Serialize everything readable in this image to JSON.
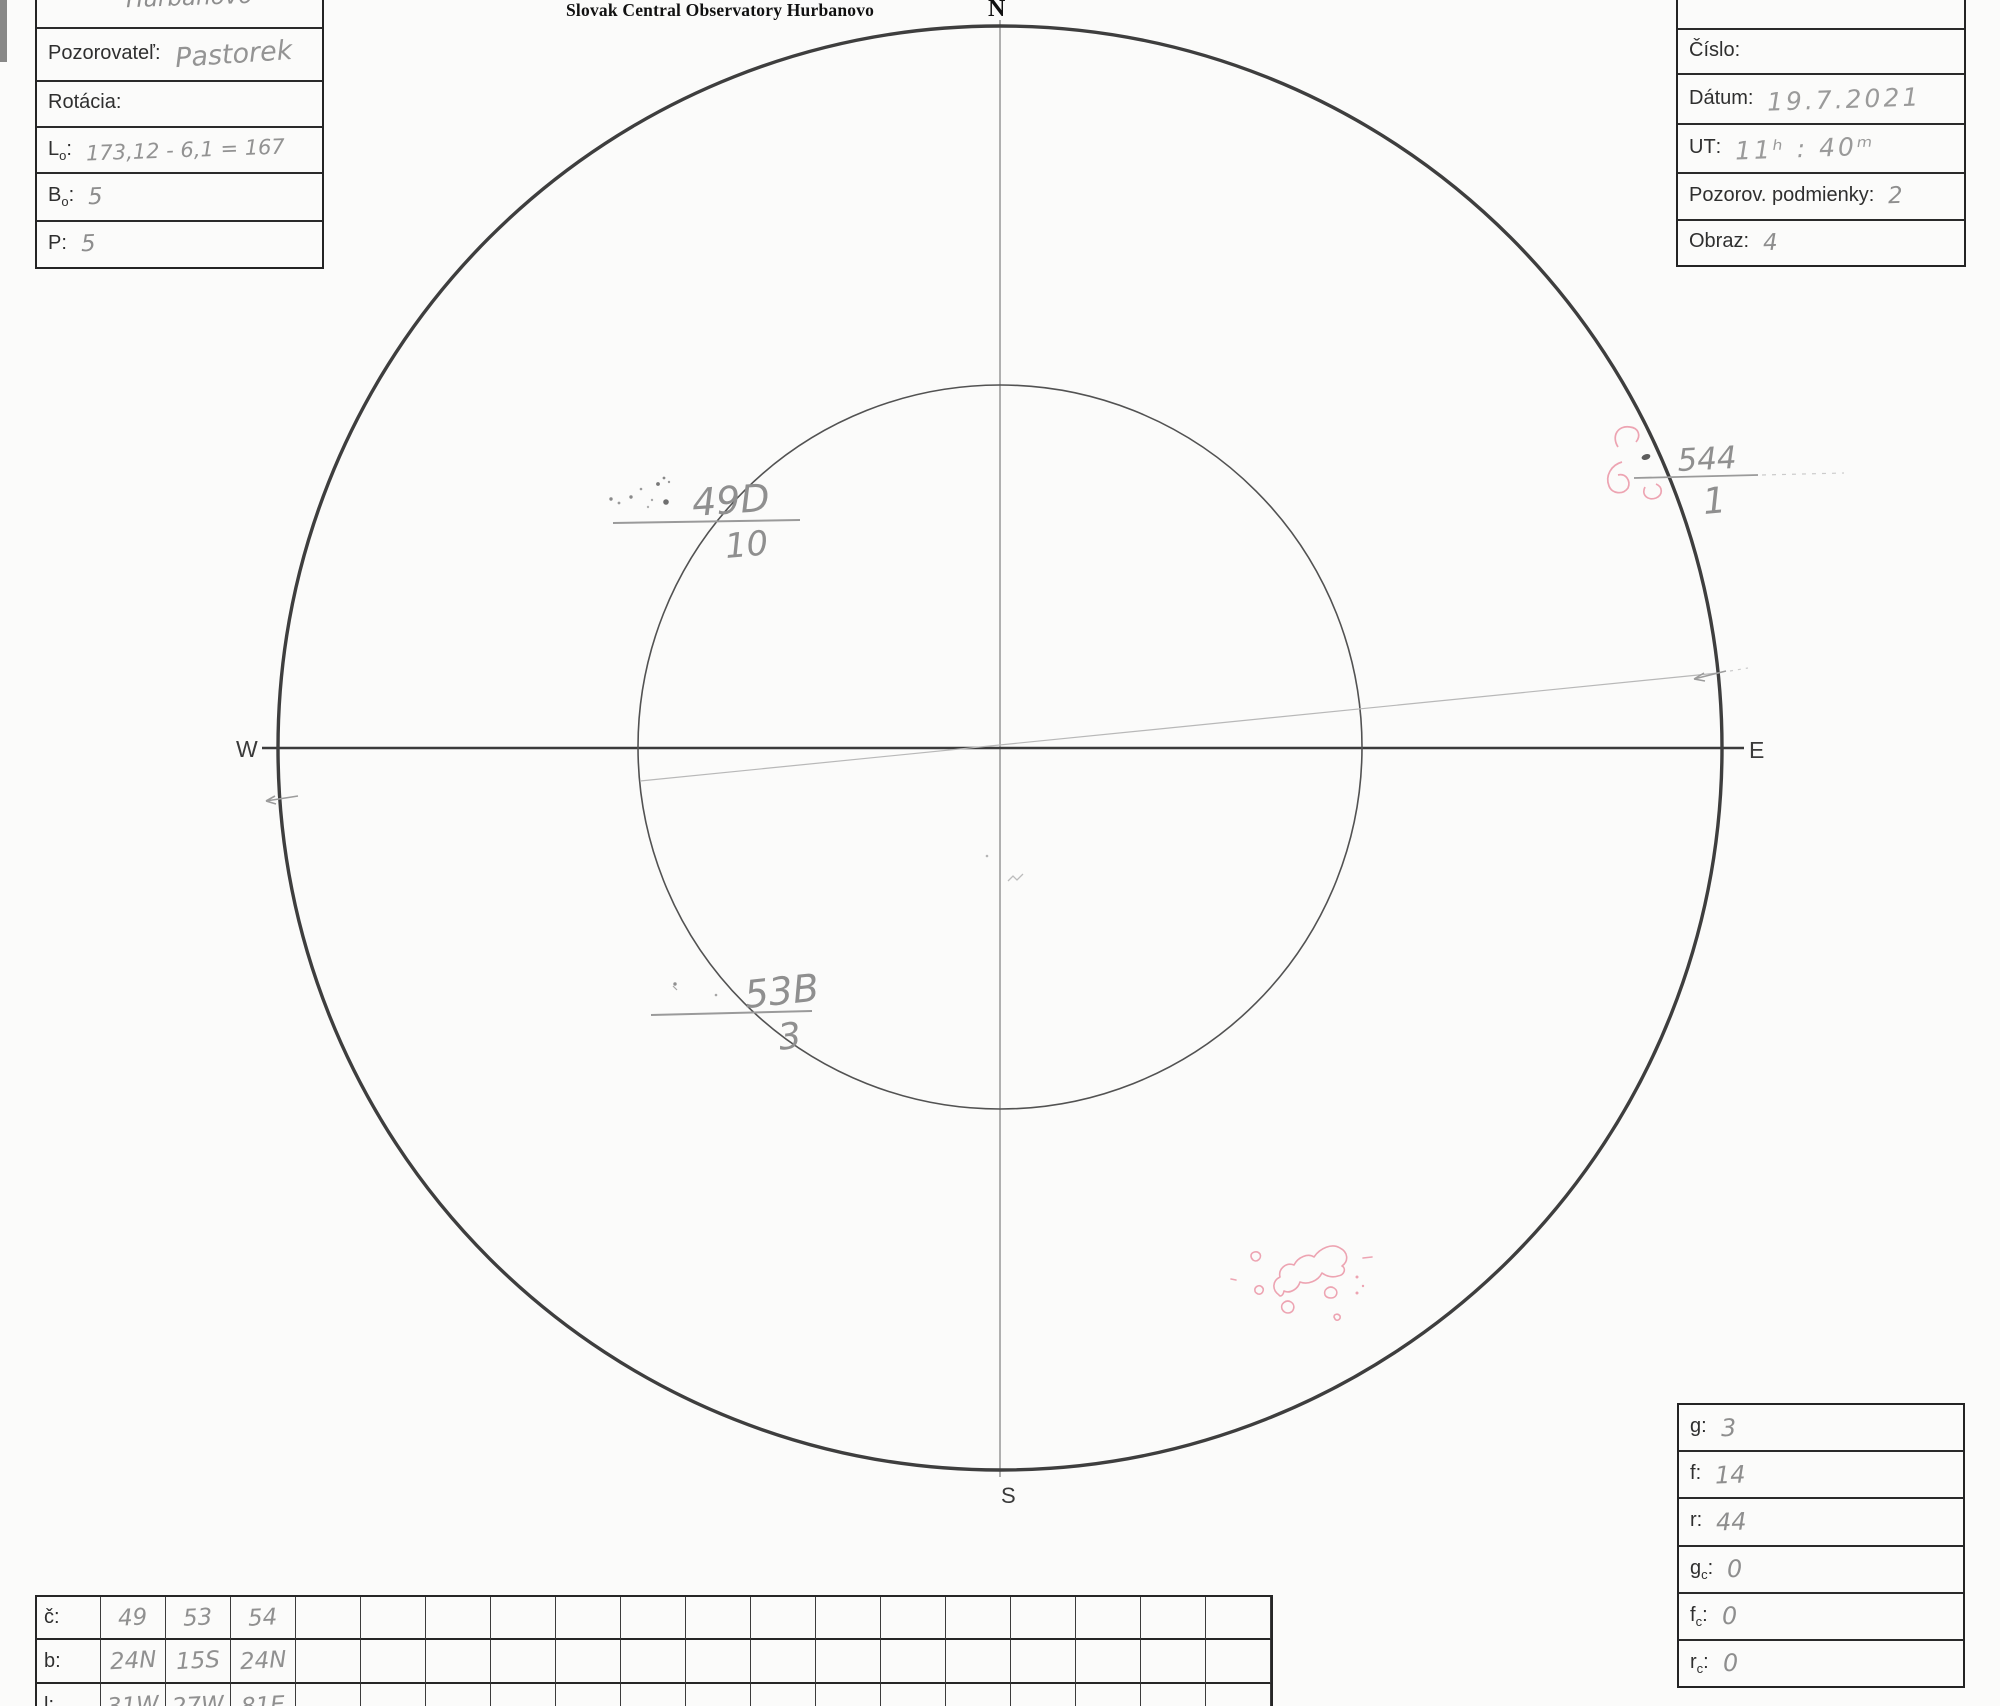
{
  "title": "Slovak Central Observatory Hurbanovo",
  "left_form": {
    "fields": [
      {
        "main": "Miesto",
        "sub": "",
        "post": ":",
        "value": "Hurbanovo"
      },
      {
        "main": "Pozorovateľ",
        "sub": "",
        "post": ":",
        "value": "Pastorek"
      },
      {
        "main": "Rotácia",
        "sub": "",
        "post": ":",
        "value": ""
      },
      {
        "main": "L",
        "sub": "o",
        "post": ":",
        "value": "173,12 - 6,1 = 167"
      },
      {
        "main": "B",
        "sub": "o",
        "post": ":",
        "value": "5"
      },
      {
        "main": "P",
        "sub": "",
        "post": ":",
        "value": "5"
      }
    ]
  },
  "right_form": {
    "header": "SLNKO",
    "fields": [
      {
        "main": "Číslo",
        "sub": "",
        "post": ":",
        "value": ""
      },
      {
        "main": "Dátum",
        "sub": "",
        "post": ":",
        "value": "19.7.2021"
      },
      {
        "main": "UT",
        "sub": "",
        "post": ":",
        "value": "11ʰ : 40ᵐ"
      },
      {
        "main": "Pozorov. podmienky",
        "sub": "",
        "post": ":",
        "value": "2"
      },
      {
        "main": "Obraz",
        "sub": "",
        "post": ":",
        "value": "4"
      }
    ]
  },
  "compass": {
    "north": "N",
    "south": "S",
    "west": "W",
    "east": "E"
  },
  "sunspot_groups": [
    {
      "designation": "49D",
      "spot_count": "10"
    },
    {
      "designation": "53B",
      "spot_count": "3"
    },
    {
      "designation": "544",
      "spot_count": "1"
    }
  ],
  "counts_box": {
    "fields": [
      {
        "main": "g",
        "sub": "",
        "post": ":",
        "value": "3"
      },
      {
        "main": "f",
        "sub": "",
        "post": ":",
        "value": "14"
      },
      {
        "main": "r",
        "sub": "",
        "post": ":",
        "value": "44"
      },
      {
        "main": "g",
        "sub": "c",
        "post": ":",
        "value": "0"
      },
      {
        "main": "f",
        "sub": "c",
        "post": ":",
        "value": "0"
      },
      {
        "main": "r",
        "sub": "c",
        "post": ":",
        "value": "0"
      }
    ]
  },
  "groups_table": {
    "rows": [
      {
        "label": "č:",
        "values": [
          "49",
          "53",
          "54"
        ]
      },
      {
        "label": "b:",
        "values": [
          "24N",
          "15S",
          "24N"
        ]
      },
      {
        "label": "l:",
        "values": [
          "31W",
          "27W",
          "81E"
        ]
      }
    ]
  },
  "colors": {
    "ink": "#2e2e2e",
    "pencil": "#8f8f8f",
    "red_pencil": "#eda4b2"
  }
}
